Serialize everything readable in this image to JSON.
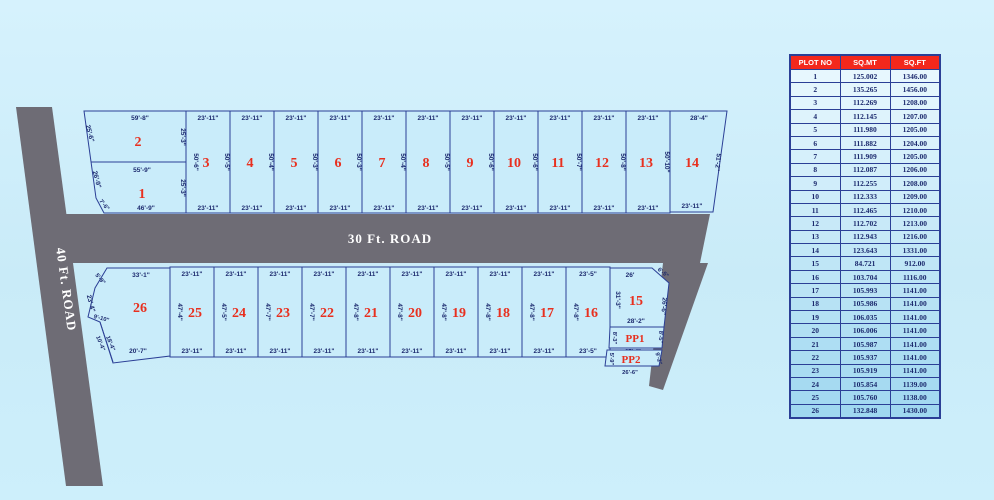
{
  "roads": {
    "left": "40 Ft. ROAD",
    "middle": "30 Ft. ROAD"
  },
  "plots": {
    "p2": {
      "num": "2",
      "top": "59'-8\"",
      "left": "25'-6\"",
      "right": "25'-3\""
    },
    "p1": {
      "num": "1",
      "top": "55'-9\"",
      "left": "26'-9\"",
      "corner": "7'-6\"",
      "right": "25'-3\"",
      "bottom": "46'-9\""
    },
    "p14": {
      "num": "14",
      "top": "28'-4\"",
      "right": "51'-2\"",
      "bottom": "23'-11\""
    },
    "p26": {
      "num": "26",
      "top": "33'-1\"",
      "corner_tl": "5'-9\"",
      "left": "23'-4\"",
      "notch": "9'-10\"",
      "diag_a": "10'-4\"",
      "diag_b": "18'-4\"",
      "bottom": "20'-7\""
    },
    "p15": {
      "num": "15",
      "top": "26'",
      "corner_tr": "6'-5\"",
      "left": "31'-3\"",
      "right": "26'-6\"",
      "bottom": "28'-2\""
    },
    "pp1": {
      "num": "PP1",
      "left": "8'-3\"",
      "right": "8'-5\"",
      "bottom": "27'-4\""
    },
    "pp2": {
      "num": "PP2",
      "left": "5'-9\"",
      "right": "9'-2\"",
      "bottom": "26'-6\""
    }
  },
  "layout": {
    "top_strip": [
      {
        "num": "3",
        "top": "23'-11\"",
        "left": "50'-6\"",
        "right": "50'-5\"",
        "bottom": "23'-11\""
      },
      {
        "num": "4",
        "top": "23'-11\"",
        "right": "50'-4\"",
        "bottom": "23'-11\""
      },
      {
        "num": "5",
        "top": "23'-11\"",
        "right": "50'-3\"",
        "bottom": "23'-11\""
      },
      {
        "num": "6",
        "top": "23'-11\"",
        "right": "50'-3\"",
        "bottom": "23'-11\""
      },
      {
        "num": "7",
        "top": "23'-11\"",
        "right": "50'-4\"",
        "bottom": "23'-11\""
      },
      {
        "num": "8",
        "top": "23'-11\"",
        "right": "50'-5\"",
        "bottom": "23'-11\""
      },
      {
        "num": "9",
        "top": "23'-11\"",
        "right": "50'-6\"",
        "bottom": "23'-11\""
      },
      {
        "num": "10",
        "top": "23'-11\"",
        "right": "50'-6\"",
        "bottom": "23'-11\""
      },
      {
        "num": "11",
        "top": "23'-11\"",
        "right": "50'-7\"",
        "bottom": "23'-11\""
      },
      {
        "num": "12",
        "top": "23'-11\"",
        "right": "50'-8\"",
        "bottom": "23'-11\""
      },
      {
        "num": "13",
        "top": "23'-11\"",
        "right": "50'-10\"",
        "bottom": "23'-11\""
      }
    ],
    "bottom_strip": [
      {
        "num": "25",
        "top": "23'-11\"",
        "left": "47'-4\"",
        "bottom": "23'-11\""
      },
      {
        "num": "24",
        "top": "23'-11\"",
        "left": "47'-5\"",
        "bottom": "23'-11\""
      },
      {
        "num": "23",
        "top": "23'-11\"",
        "left": "47'-7\"",
        "bottom": "23'-11\""
      },
      {
        "num": "22",
        "top": "23'-11\"",
        "left": "47'-7\"",
        "bottom": "23'-11\""
      },
      {
        "num": "21",
        "top": "23'-11\"",
        "left": "47'-8\"",
        "bottom": "23'-11\""
      },
      {
        "num": "20",
        "top": "23'-11\"",
        "left": "47'-8\"",
        "bottom": "23'-11\""
      },
      {
        "num": "19",
        "top": "23'-11\"",
        "left": "47'-8\"",
        "bottom": "23'-11\""
      },
      {
        "num": "18",
        "top": "23'-11\"",
        "left": "47'-8\"",
        "bottom": "23'-11\""
      },
      {
        "num": "17",
        "top": "23'-11\"",
        "left": "47'-8\"",
        "bottom": "23'-11\""
      },
      {
        "num": "16",
        "top": "23'-5\"",
        "left": "47'-8\"",
        "bottom": "23'-5\""
      }
    ]
  },
  "colors": {
    "background": "#cdeefa",
    "plot_fill": "#c9ecfa",
    "plot_border": "#2b3f96",
    "road": "#6e6c75",
    "plot_number": "#e8301f",
    "dim_text": "#1c2a6e",
    "table_header_bg": "#f3281c",
    "table_header_text": "#ffffff"
  },
  "table": {
    "headers": [
      "PLOT NO",
      "SQ.MT",
      "SQ.FT"
    ],
    "rows": [
      [
        "1",
        "125.002",
        "1346.00"
      ],
      [
        "2",
        "135.265",
        "1456.00"
      ],
      [
        "3",
        "112.269",
        "1208.00"
      ],
      [
        "4",
        "112.145",
        "1207.00"
      ],
      [
        "5",
        "111.980",
        "1205.00"
      ],
      [
        "6",
        "111.882",
        "1204.00"
      ],
      [
        "7",
        "111.909",
        "1205.00"
      ],
      [
        "8",
        "112.087",
        "1206.00"
      ],
      [
        "9",
        "112.255",
        "1208.00"
      ],
      [
        "10",
        "112.333",
        "1209.00"
      ],
      [
        "11",
        "112.465",
        "1210.00"
      ],
      [
        "12",
        "112.702",
        "1213.00"
      ],
      [
        "13",
        "112.943",
        "1216.00"
      ],
      [
        "14",
        "123.643",
        "1331.00"
      ],
      [
        "15",
        "84.721",
        "912.00"
      ],
      [
        "16",
        "103.704",
        "1116.00"
      ],
      [
        "17",
        "105.993",
        "1141.00"
      ],
      [
        "18",
        "105.986",
        "1141.00"
      ],
      [
        "19",
        "106.035",
        "1141.00"
      ],
      [
        "20",
        "106.006",
        "1141.00"
      ],
      [
        "21",
        "105.987",
        "1141.00"
      ],
      [
        "22",
        "105.937",
        "1141.00"
      ],
      [
        "23",
        "105.919",
        "1141.00"
      ],
      [
        "24",
        "105.854",
        "1139.00"
      ],
      [
        "25",
        "105.760",
        "1138.00"
      ],
      [
        "26",
        "132.848",
        "1430.00"
      ]
    ]
  }
}
